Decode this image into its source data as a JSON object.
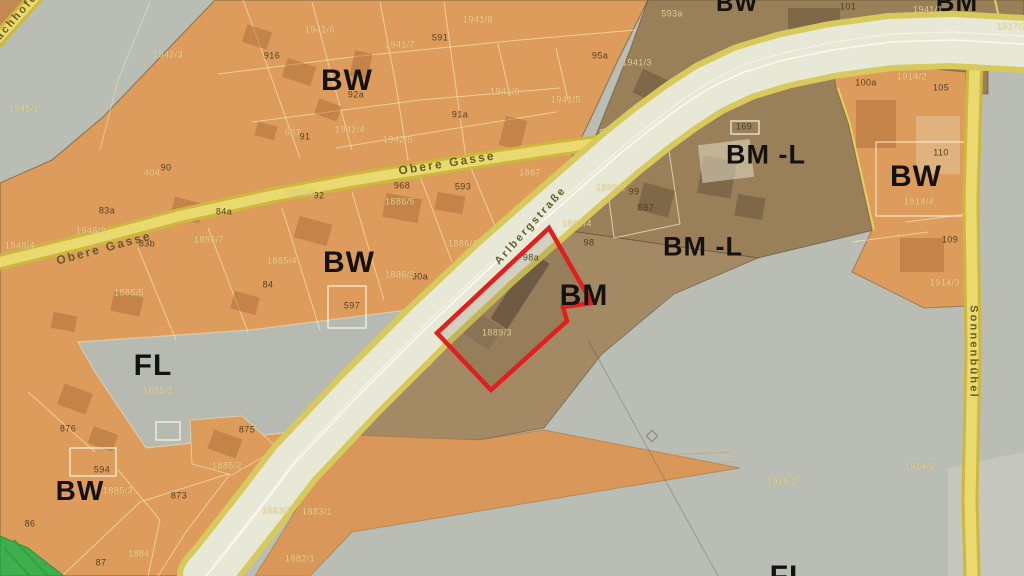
{
  "map": {
    "description": "zoning-aerial-map",
    "zone_labels": [
      {
        "text": "BW",
        "x": 347,
        "y": 81,
        "size": 30
      },
      {
        "text": "BW",
        "x": 737,
        "y": 4,
        "size": 24
      },
      {
        "text": "BM",
        "x": 957,
        "y": 2,
        "size": 26
      },
      {
        "text": "BM -L",
        "x": 766,
        "y": 155,
        "size": 27
      },
      {
        "text": "BM -L",
        "x": 703,
        "y": 247,
        "size": 27
      },
      {
        "text": "BW",
        "x": 349,
        "y": 263,
        "size": 30
      },
      {
        "text": "BW",
        "x": 916,
        "y": 177,
        "size": 30
      },
      {
        "text": "BM",
        "x": 584,
        "y": 296,
        "size": 30
      },
      {
        "text": "FL",
        "x": 153,
        "y": 366,
        "size": 30
      },
      {
        "text": "BW",
        "x": 80,
        "y": 491,
        "size": 28
      },
      {
        "text": "FL",
        "x": 789,
        "y": 577,
        "size": 30
      }
    ],
    "parcel_labels_dark": [
      {
        "text": "916",
        "x": 272,
        "y": 56
      },
      {
        "text": "591",
        "x": 440,
        "y": 38
      },
      {
        "text": "95a",
        "x": 600,
        "y": 56
      },
      {
        "text": "91a",
        "x": 460,
        "y": 115
      },
      {
        "text": "92a",
        "x": 356,
        "y": 95
      },
      {
        "text": "91",
        "x": 305,
        "y": 137
      },
      {
        "text": "90",
        "x": 166,
        "y": 168
      },
      {
        "text": "968",
        "x": 402,
        "y": 186
      },
      {
        "text": "593",
        "x": 463,
        "y": 187
      },
      {
        "text": "92",
        "x": 319,
        "y": 196
      },
      {
        "text": "83a",
        "x": 107,
        "y": 211
      },
      {
        "text": "84a",
        "x": 224,
        "y": 212
      },
      {
        "text": "83b",
        "x": 147,
        "y": 244
      },
      {
        "text": "84",
        "x": 268,
        "y": 285
      },
      {
        "text": "90a",
        "x": 420,
        "y": 277
      },
      {
        "text": "597",
        "x": 352,
        "y": 306
      },
      {
        "text": "98a",
        "x": 531,
        "y": 258
      },
      {
        "text": "98",
        "x": 589,
        "y": 243
      },
      {
        "text": "99",
        "x": 634,
        "y": 192
      },
      {
        "text": "597",
        "x": 646,
        "y": 208
      },
      {
        "text": "169",
        "x": 744,
        "y": 127
      },
      {
        "text": "101",
        "x": 848,
        "y": 7
      },
      {
        "text": "100a",
        "x": 866,
        "y": 83
      },
      {
        "text": "105",
        "x": 941,
        "y": 88
      },
      {
        "text": "110",
        "x": 941,
        "y": 153
      },
      {
        "text": "109",
        "x": 950,
        "y": 240
      },
      {
        "text": "876",
        "x": 68,
        "y": 429
      },
      {
        "text": "594",
        "x": 102,
        "y": 470
      },
      {
        "text": "875",
        "x": 247,
        "y": 430
      },
      {
        "text": "873",
        "x": 179,
        "y": 496
      },
      {
        "text": "86",
        "x": 30,
        "y": 524
      },
      {
        "text": "87",
        "x": 101,
        "y": 563
      }
    ],
    "parcel_labels_faint": [
      {
        "text": "1942/3",
        "x": 168,
        "y": 55
      },
      {
        "text": "1945/1",
        "x": 24,
        "y": 109
      },
      {
        "text": "1941/6",
        "x": 320,
        "y": 30
      },
      {
        "text": "1941/7",
        "x": 400,
        "y": 45
      },
      {
        "text": "1941/8",
        "x": 478,
        "y": 20
      },
      {
        "text": "593a",
        "x": 672,
        "y": 14
      },
      {
        "text": "1941/3",
        "x": 637,
        "y": 63
      },
      {
        "text": "1941/9",
        "x": 505,
        "y": 92
      },
      {
        "text": "1941/5",
        "x": 566,
        "y": 100
      },
      {
        "text": "1942/4",
        "x": 350,
        "y": 130
      },
      {
        "text": "1942/5",
        "x": 398,
        "y": 140
      },
      {
        "text": "637",
        "x": 293,
        "y": 133
      },
      {
        "text": "404",
        "x": 152,
        "y": 173
      },
      {
        "text": "1887",
        "x": 530,
        "y": 173
      },
      {
        "text": "1885/8",
        "x": 301,
        "y": 193
      },
      {
        "text": "1886/5",
        "x": 400,
        "y": 202
      },
      {
        "text": "1948/3",
        "x": 91,
        "y": 231
      },
      {
        "text": "1948/4",
        "x": 20,
        "y": 246
      },
      {
        "text": "1885/7",
        "x": 209,
        "y": 240
      },
      {
        "text": "1886/1",
        "x": 463,
        "y": 244
      },
      {
        "text": "1886/3",
        "x": 400,
        "y": 275
      },
      {
        "text": "1885/4",
        "x": 282,
        "y": 261
      },
      {
        "text": "1885/5",
        "x": 129,
        "y": 293
      },
      {
        "text": "1889/4",
        "x": 577,
        "y": 224
      },
      {
        "text": "1889/2",
        "x": 611,
        "y": 188
      },
      {
        "text": "1889/3",
        "x": 497,
        "y": 333
      },
      {
        "text": "1941/1",
        "x": 928,
        "y": 10
      },
      {
        "text": "1917/2",
        "x": 1012,
        "y": 27
      },
      {
        "text": "1914/2",
        "x": 912,
        "y": 77
      },
      {
        "text": "1914/4",
        "x": 919,
        "y": 202
      },
      {
        "text": "1914/3",
        "x": 945,
        "y": 283
      },
      {
        "text": "1885/1",
        "x": 158,
        "y": 391
      },
      {
        "text": "1885/2",
        "x": 227,
        "y": 466
      },
      {
        "text": "1885/3",
        "x": 118,
        "y": 491
      },
      {
        "text": "1883/2",
        "x": 277,
        "y": 511
      },
      {
        "text": "1883/1",
        "x": 317,
        "y": 512
      },
      {
        "text": "1882/1",
        "x": 300,
        "y": 559
      },
      {
        "text": "1884",
        "x": 139,
        "y": 554
      },
      {
        "text": "1915/2",
        "x": 782,
        "y": 482
      },
      {
        "text": "1914/1",
        "x": 920,
        "y": 467
      }
    ],
    "street_labels": [
      {
        "text": "Obere  Gasse",
        "x": 104,
        "y": 248,
        "rot": -15,
        "size": 12
      },
      {
        "text": "Obere  Gasse",
        "x": 447,
        "y": 163,
        "rot": -9,
        "size": 12
      },
      {
        "text": "Arlbergstraße",
        "x": 531,
        "y": 226,
        "rot": -48,
        "size": 11
      },
      {
        "text": "Sonnenbühel",
        "x": 973,
        "y": 352,
        "rot": 90,
        "size": 11
      },
      {
        "text": "bachhofen",
        "x": 17,
        "y": 17,
        "rot": -49,
        "size": 11
      }
    ],
    "colors": {
      "zone_orange": "#dd9c5c",
      "zone_brown": "#a38a64",
      "zone_brown_dark": "#998059",
      "zone_gray": "#b9bdb3",
      "zone_gray_light": "#c5c7bf",
      "road_fill": "#e8e8d6",
      "road_edge": "#d8c95c",
      "minor_road": "#d9c44e",
      "minor_road_core": "#ecdc74",
      "red_outline": "#e01f1f",
      "green_strip": "#3fae4e"
    }
  }
}
